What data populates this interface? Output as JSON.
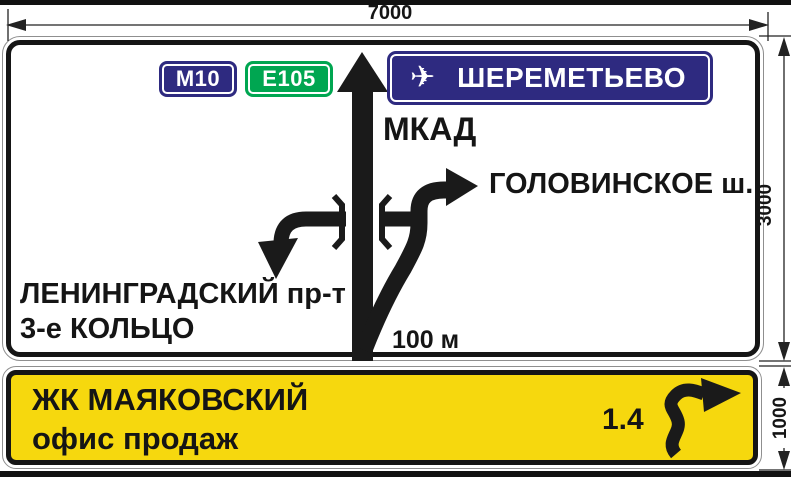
{
  "measurements": {
    "width": "7000",
    "main_height": "3000",
    "panel_height": "1000"
  },
  "direction_sign": {
    "route_badges": [
      {
        "label": "М10"
      },
      {
        "label": "E105"
      }
    ],
    "airport_panel": {
      "icon": "✈",
      "label": "ШЕРЕМЕТЬЕВО"
    },
    "straight_road_label": "МКАД",
    "right_exit_label": "ГОЛОВИНСКОЕ ш.",
    "left_exit_label_line1": "ЛЕНИНГРАДСКИЙ пр-т",
    "left_exit_label_line2": "3-е КОЛЬЦО",
    "distance_label": "100 м"
  },
  "info_sign": {
    "title": "ЖК МАЯКОВСКИЙ",
    "subtitle": "офис продаж",
    "distance_km": "1.4"
  },
  "colors": {
    "badge_blue": "#2e2a80",
    "badge_green": "#00a651",
    "panel_blue": "#2e2a80",
    "sign_yellow": "#f6d80e",
    "ink_black": "#1a1a1a"
  }
}
